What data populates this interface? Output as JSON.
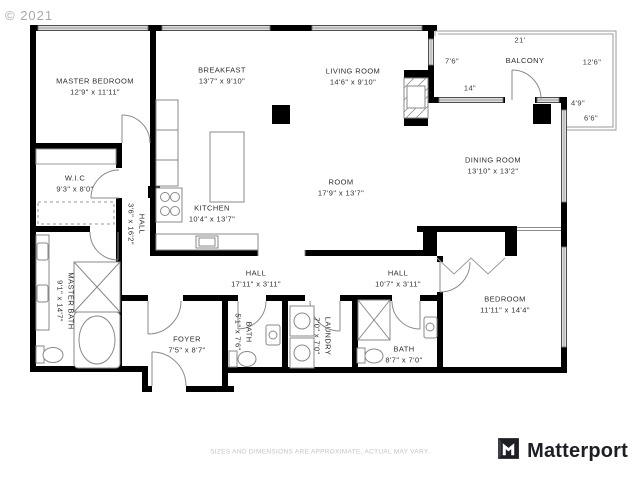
{
  "copyright": "© 2021",
  "disclaimer": "SIZES AND DIMENSIONS ARE APPROXIMATE, ACTUAL MAY VARY.",
  "brand": {
    "name": "Matterport"
  },
  "rooms": [
    {
      "name": "MASTER BEDROOM",
      "dims": "12'9\" x 11'11\""
    },
    {
      "name": "BREAKFAST",
      "dims": "13'7\" x 9'10\""
    },
    {
      "name": "LIVING ROOM",
      "dims": "14'6\" x 9'10\""
    },
    {
      "name": "DINING ROOM",
      "dims": "13'10\" x 13'2\""
    },
    {
      "name": "ROOM",
      "dims": "17'9\" x 13'7\""
    },
    {
      "name": "W.I.C",
      "dims": "9'3\" x 8'0\""
    },
    {
      "name": "KITCHEN",
      "dims": "10'4\" x 13'7\""
    },
    {
      "name": "HALL",
      "dims": "3'6\" x 16'2\""
    },
    {
      "name": "MASTER BATH",
      "dims": "9'1\" x 14'7\""
    },
    {
      "name": "HALL",
      "dims": "17'11\" x 3'11\""
    },
    {
      "name": "FOYER",
      "dims": "7'5\" x 8'7\""
    },
    {
      "name": "BATH",
      "dims": "5'1\" x 7'6\""
    },
    {
      "name": "LAUNDRY",
      "dims": "7'0\" x 7'0\""
    },
    {
      "name": "HALL",
      "dims": "10'7\" x 3'11\""
    },
    {
      "name": "BATH",
      "dims": "8'7\" x 7'0\""
    },
    {
      "name": "BEDROOM",
      "dims": "11'11\" x 14'4\""
    }
  ],
  "balcony": {
    "label": "BALCONY",
    "dim_top": "21'",
    "dim_left": "7'6\"",
    "dim_right": "12'6\"",
    "dim_window": "14\"",
    "dim_side_a": "4'9\"",
    "dim_side_b": "6'6\""
  },
  "colors": {
    "wall": "#000000",
    "fixture_line": "#8a8a8a",
    "label_text": "#2e2e2e"
  }
}
